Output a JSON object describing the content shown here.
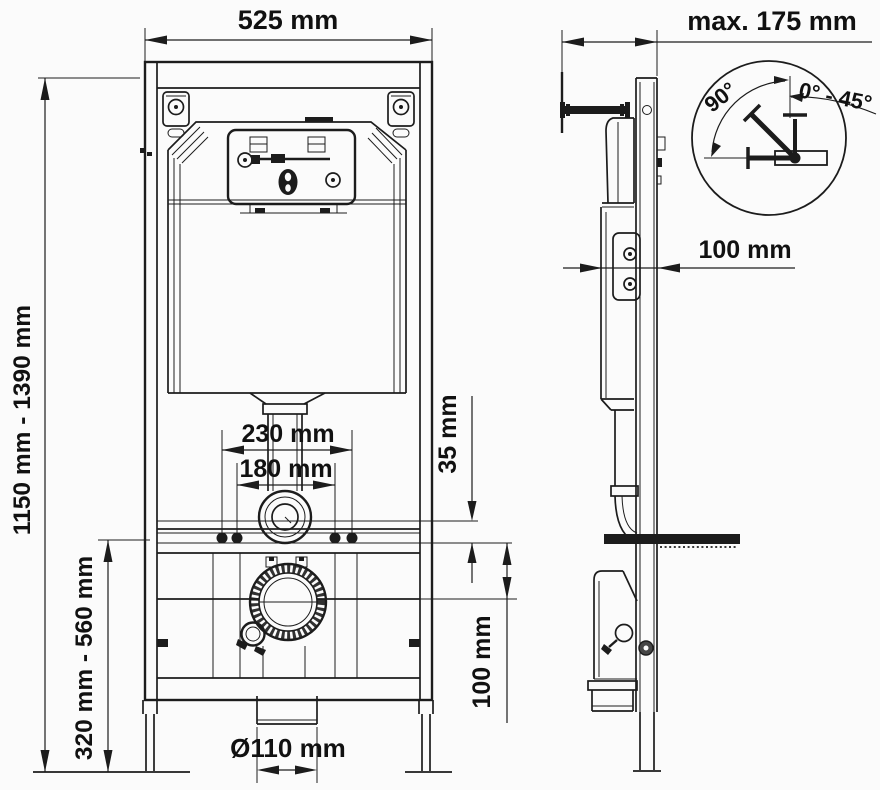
{
  "colors": {
    "line": "#1c1c1c",
    "background": "#fbfbfb"
  },
  "dimensions": {
    "front": {
      "width": "525 mm",
      "height_range": "1150 mm - 1390 mm",
      "lower_height_range": "320 mm - 560 mm",
      "fixing_spacing_outer": "230 mm",
      "fixing_spacing_inner": "180 mm",
      "rail_offset": "35 mm",
      "outlet_drop": "100 mm",
      "outlet_diameter": "Ø110 mm"
    },
    "side": {
      "wall_clearance": "max. 175 mm",
      "frame_depth": "100 mm"
    },
    "detail": {
      "sweep_angle": "90°",
      "adjust_range": "0° - 45°"
    }
  }
}
